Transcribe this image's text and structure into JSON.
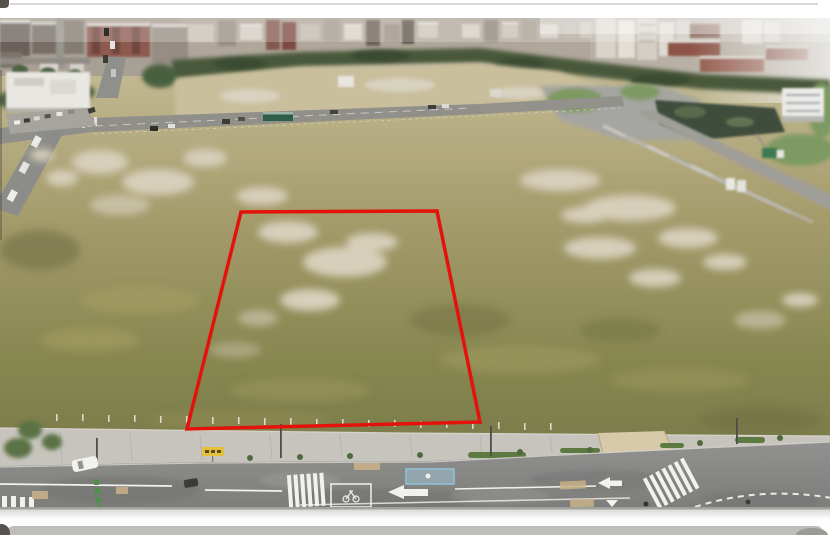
{
  "meta": {
    "type": "aerial-photograph",
    "description": "Drone aerial photograph of a large cleared land-development site. A red boundary polygon marks a rectangular parcel within the weedy field. Dense city buildings line the horizon behind a dark tree belt; a newly built boulevard with crosswalks, a bike box, turn arrows and a scooter waiting box runs across the foreground."
  },
  "frame": {
    "background": "#ffffff",
    "top_line": "#cbcbc9",
    "bottom_edge_line": "#a0a09d",
    "bottom_band": "#bdbdba",
    "corner_dark": "#56524e"
  },
  "photo": {
    "colors": {
      "city_base": "#b0a79b",
      "city_base_left": "#a9a095",
      "sky_haze": "#ebeae6",
      "tree_belt": "#49593a",
      "upper_strip": "#c9bf9d",
      "field_top": "#c6bc96",
      "field_bottom": "#7a7b4a",
      "bare_patch": "#d6cfba",
      "wall": "#c7c4bd",
      "road": "#8b8b88",
      "marking_white": "#f1f1ee",
      "marking_green": "#4e8f4c",
      "scooter_box_blue": "#8fc4dc",
      "sign_yellow": "#e3bf3a",
      "pond": "#414e3d",
      "lawn": "#7e9a62",
      "white_building": "#ecebe7",
      "retail_building": "#e9e7e2",
      "hedge": "#5d7a42",
      "brick_school": "#8d5247"
    }
  },
  "annotation": {
    "name": "parcel-boundary",
    "shape": "polygon",
    "points": "241,212 437,211 480,422 187,429",
    "color": "#e3120b",
    "stroke_width": 3.5
  }
}
